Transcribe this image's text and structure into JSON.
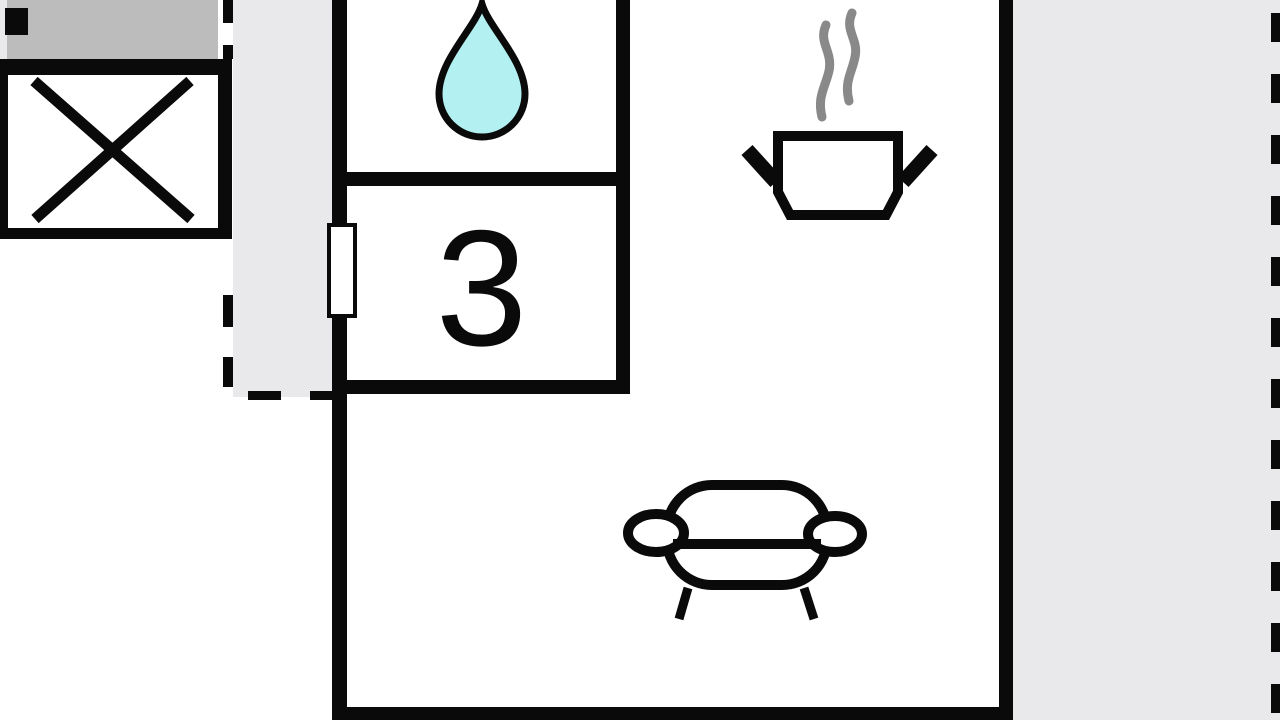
{
  "colors": {
    "wall": "#0a0a0a",
    "zone_gray": "#e9e9eb",
    "terrace_gray": "#bcbcbc",
    "drop_fill": "#b3f0f1",
    "steam_gray": "#898989",
    "paper": "#ffffff"
  },
  "rooms": {
    "bedroom": {
      "number": "3"
    },
    "bathroom": {
      "icon": "water-drop-icon"
    },
    "kitchen": {
      "icon": "cooking-pot-icon"
    },
    "living": {
      "icon": "sofa-icon"
    },
    "elevator": {
      "icon": "crossed-box-icon"
    }
  }
}
